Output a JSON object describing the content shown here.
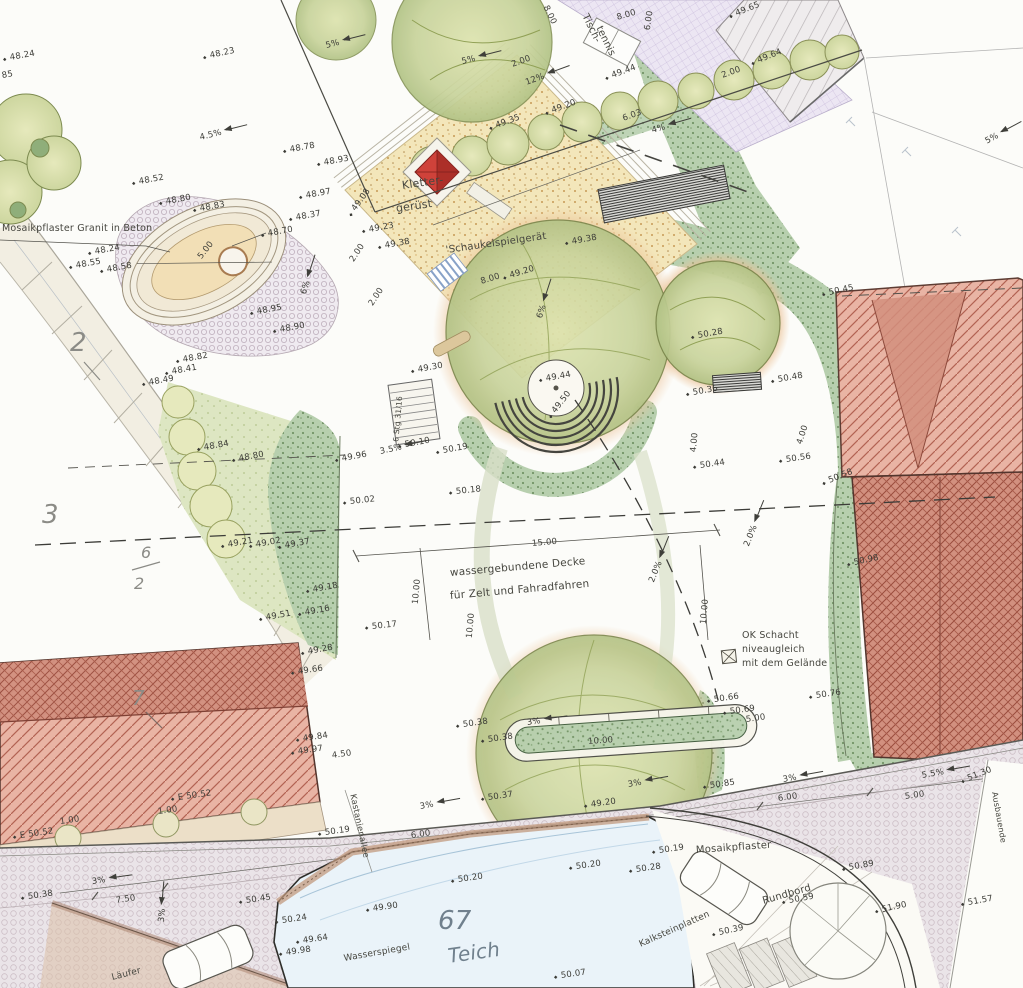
{
  "drawing": {
    "kind": "landscape-site-plan",
    "language": "de",
    "pond_parcel": "67",
    "parcels": [
      "2",
      "3",
      "6/2",
      "7",
      "67"
    ]
  },
  "colors": {
    "paper": "#fcfcf9",
    "roof_red_light": "#e9b4a4",
    "roof_red_dark": "#d2907f",
    "lawn_green": "#dde6c2",
    "shrub_green": "#b7cfae",
    "sand_yellow": "#f3e6ba",
    "pond_blue": "#eaf3f9",
    "pavement_grid": "#ece6f3",
    "road_mosaic": "#eae4e8",
    "play_structure_red": "#cf423a",
    "ink": "#3b3b36"
  },
  "texts": {
    "mosaic_note": "Mosaikpflaster Granit in Beton",
    "surface_note_line1": "wassergebundene Decke",
    "surface_note_line2": "für Zelt und Fahradfahren",
    "shaft_note": "OK Schacht niveaugleich mit dem Gelände",
    "pond_label": "Teich",
    "water_level": "Wasserspiegel",
    "street": "Kastanienallee"
  },
  "labels": [
    {
      "t": "48.23",
      "x": 210,
      "y": 52,
      "r": -12
    },
    {
      "t": "48.37",
      "x": 296,
      "y": 214,
      "r": -10
    },
    {
      "t": "48.24",
      "x": 10,
      "y": 54,
      "r": -10
    },
    {
      "t": "85",
      "x": 2,
      "y": 72,
      "r": -10
    },
    {
      "t": "4.5%",
      "x": 200,
      "y": 134,
      "r": -14,
      "k": "s"
    },
    {
      "t": "5%",
      "x": 326,
      "y": 42,
      "r": -14,
      "k": "s"
    },
    {
      "t": "5%",
      "x": 462,
      "y": 58,
      "r": -14,
      "k": "s"
    },
    {
      "t": "5%",
      "x": 986,
      "y": 138,
      "r": -28,
      "k": "s"
    },
    {
      "t": "48.78",
      "x": 290,
      "y": 146,
      "r": -10
    },
    {
      "t": "48.93",
      "x": 324,
      "y": 159,
      "r": -10
    },
    {
      "t": "48.97",
      "x": 306,
      "y": 192,
      "r": -10
    },
    {
      "t": "48.52",
      "x": 139,
      "y": 178,
      "r": -10
    },
    {
      "t": "48.80",
      "x": 166,
      "y": 198,
      "r": -10
    },
    {
      "t": "48.83",
      "x": 200,
      "y": 205,
      "r": -10
    },
    {
      "t": "48.70",
      "x": 268,
      "y": 230,
      "r": -10
    },
    {
      "t": "48.24",
      "x": 95,
      "y": 248,
      "r": -10
    },
    {
      "t": "48.55",
      "x": 76,
      "y": 262,
      "r": -10
    },
    {
      "t": "48.58",
      "x": 107,
      "y": 266,
      "r": -10
    },
    {
      "t": "5.00",
      "x": 200,
      "y": 254,
      "r": -52,
      "k": "d"
    },
    {
      "t": "48.95",
      "x": 257,
      "y": 308,
      "r": -10
    },
    {
      "t": "48.90",
      "x": 280,
      "y": 326,
      "r": -10
    },
    {
      "t": "6%",
      "x": 304,
      "y": 290,
      "r": -72,
      "k": "s"
    },
    {
      "t": "48.82",
      "x": 183,
      "y": 356,
      "r": -10
    },
    {
      "t": "48.41",
      "x": 172,
      "y": 368,
      "r": -10
    },
    {
      "t": "48.49",
      "x": 149,
      "y": 379,
      "r": -10
    },
    {
      "t": "Mosaikpflaster Granit in Beton",
      "x": 2,
      "y": 224,
      "r": 0,
      "s": 9.5,
      "k": "n"
    },
    {
      "t": "2",
      "x": 70,
      "y": 330,
      "r": 0,
      "s": 26,
      "k": "p"
    },
    {
      "t": "Kletter-",
      "x": 402,
      "y": 180,
      "r": -8,
      "s": 11,
      "k": "n"
    },
    {
      "t": "gerüst",
      "x": 396,
      "y": 203,
      "r": -8,
      "s": 11,
      "k": "n"
    },
    {
      "t": "'Schaukelspielgerät",
      "x": 446,
      "y": 246,
      "r": -8,
      "s": 10,
      "k": "n"
    },
    {
      "t": "49.08",
      "x": 354,
      "y": 206,
      "r": -54
    },
    {
      "t": "49.23",
      "x": 369,
      "y": 226,
      "r": -10
    },
    {
      "t": "49.38",
      "x": 385,
      "y": 242,
      "r": -10
    },
    {
      "t": "2.00",
      "x": 352,
      "y": 257,
      "r": -56,
      "k": "d"
    },
    {
      "t": "2.00",
      "x": 371,
      "y": 301,
      "r": -56,
      "k": "d"
    },
    {
      "t": "8.00",
      "x": 481,
      "y": 278,
      "r": -17,
      "k": "d"
    },
    {
      "t": "49.20",
      "x": 510,
      "y": 272,
      "r": -17
    },
    {
      "t": "49.38",
      "x": 572,
      "y": 238,
      "r": -10
    },
    {
      "t": "6%",
      "x": 540,
      "y": 314,
      "r": -72,
      "k": "s"
    },
    {
      "t": "49.30",
      "x": 418,
      "y": 366,
      "r": -10
    },
    {
      "t": "49.44",
      "x": 546,
      "y": 375,
      "r": -10
    },
    {
      "t": "49.50",
      "x": 554,
      "y": 408,
      "r": -52
    },
    {
      "t": "Tisch-",
      "x": 584,
      "y": 10,
      "r": 64,
      "s": 10,
      "k": "n"
    },
    {
      "t": "tennis",
      "x": 598,
      "y": 22,
      "r": 64,
      "s": 10,
      "k": "n"
    },
    {
      "t": "8.00",
      "x": 545,
      "y": 2,
      "r": 64,
      "k": "d"
    },
    {
      "t": "6.00",
      "x": 648,
      "y": 26,
      "r": -82,
      "k": "d"
    },
    {
      "t": "8.00",
      "x": 617,
      "y": 14,
      "r": -16,
      "k": "d"
    },
    {
      "t": "49.44",
      "x": 612,
      "y": 72,
      "r": -20
    },
    {
      "t": "49.65",
      "x": 736,
      "y": 10,
      "r": -22
    },
    {
      "t": "49.64",
      "x": 758,
      "y": 57,
      "r": -22
    },
    {
      "t": "2.00",
      "x": 512,
      "y": 61,
      "r": -20,
      "k": "d"
    },
    {
      "t": "2.00",
      "x": 722,
      "y": 72,
      "r": -20,
      "k": "d"
    },
    {
      "t": "12%",
      "x": 526,
      "y": 79,
      "r": -20,
      "k": "s"
    },
    {
      "t": "49.20",
      "x": 552,
      "y": 107,
      "r": -20
    },
    {
      "t": "49.35",
      "x": 496,
      "y": 122,
      "r": -20
    },
    {
      "t": "6.03",
      "x": 623,
      "y": 115,
      "r": -20,
      "k": "d"
    },
    {
      "t": "4%",
      "x": 652,
      "y": 127,
      "r": -16,
      "k": "s"
    },
    {
      "t": "6 Stg 31/16",
      "x": 396,
      "y": 438,
      "r": -85,
      "s": 7.5,
      "k": "n"
    },
    {
      "t": "50.10",
      "x": 405,
      "y": 441,
      "r": -10
    },
    {
      "t": "50.19",
      "x": 443,
      "y": 447,
      "r": -10
    },
    {
      "t": "49.96",
      "x": 342,
      "y": 455,
      "r": -10
    },
    {
      "t": "3.5%",
      "x": 380,
      "y": 448,
      "r": -12,
      "k": "s"
    },
    {
      "t": "50.02",
      "x": 350,
      "y": 498,
      "r": -6
    },
    {
      "t": "50.18",
      "x": 456,
      "y": 488,
      "r": -6
    },
    {
      "t": "15.00",
      "x": 532,
      "y": 540,
      "r": -5,
      "k": "d"
    },
    {
      "t": "10.00",
      "x": 416,
      "y": 600,
      "r": -85,
      "k": "d"
    },
    {
      "t": "10.00",
      "x": 470,
      "y": 634,
      "r": -85,
      "k": "d"
    },
    {
      "t": "10.00",
      "x": 704,
      "y": 620,
      "r": -85,
      "k": "d"
    },
    {
      "t": "wassergebundene Decke",
      "x": 450,
      "y": 568,
      "r": -5,
      "s": 10.5,
      "k": "n"
    },
    {
      "t": "für Zelt und Fahradfahren",
      "x": 450,
      "y": 591,
      "r": -5,
      "s": 10.5,
      "k": "n"
    },
    {
      "t": "50.17",
      "x": 372,
      "y": 623,
      "r": -6
    },
    {
      "t": "2.0%",
      "x": 652,
      "y": 578,
      "r": -68,
      "k": "s"
    },
    {
      "t": "2.0%",
      "x": 747,
      "y": 542,
      "r": -68,
      "k": "s"
    },
    {
      "t": "3",
      "x": 42,
      "y": 502,
      "r": 0,
      "s": 26,
      "k": "p"
    },
    {
      "t": "6",
      "x": 141,
      "y": 545,
      "r": 0,
      "s": 16,
      "k": "p"
    },
    {
      "t": "2",
      "x": 134,
      "y": 576,
      "r": 0,
      "s": 16,
      "k": "p"
    },
    {
      "t": "48.84",
      "x": 204,
      "y": 444,
      "r": -10
    },
    {
      "t": "48.80",
      "x": 239,
      "y": 455,
      "r": -10
    },
    {
      "t": "49.21",
      "x": 228,
      "y": 541,
      "r": -10
    },
    {
      "t": "49.02",
      "x": 256,
      "y": 541,
      "r": -10
    },
    {
      "t": "49.37",
      "x": 285,
      "y": 542,
      "r": -10
    },
    {
      "t": "49.18",
      "x": 313,
      "y": 586,
      "r": -10
    },
    {
      "t": "49.16",
      "x": 305,
      "y": 609,
      "r": -10
    },
    {
      "t": "49.51",
      "x": 266,
      "y": 614,
      "r": -10
    },
    {
      "t": "49.28",
      "x": 308,
      "y": 648,
      "r": -10
    },
    {
      "t": "50.45",
      "x": 829,
      "y": 289,
      "r": -12
    },
    {
      "t": "50.28",
      "x": 698,
      "y": 332,
      "r": -10
    },
    {
      "t": "50.48",
      "x": 778,
      "y": 376,
      "r": -10
    },
    {
      "t": "50.36",
      "x": 693,
      "y": 389,
      "r": -10
    },
    {
      "t": "4.00",
      "x": 694,
      "y": 448,
      "r": -85,
      "k": "d"
    },
    {
      "t": "4.00",
      "x": 800,
      "y": 440,
      "r": -72,
      "k": "d"
    },
    {
      "t": "50.44",
      "x": 700,
      "y": 462,
      "r": -8
    },
    {
      "t": "50.56",
      "x": 786,
      "y": 456,
      "r": -8
    },
    {
      "t": "50.58",
      "x": 829,
      "y": 477,
      "r": -22
    },
    {
      "t": "50.98",
      "x": 854,
      "y": 559,
      "r": -12
    },
    {
      "t": "OK Schacht",
      "x": 742,
      "y": 631,
      "r": 0,
      "s": 9.5,
      "k": "n"
    },
    {
      "t": "niveaugleich",
      "x": 742,
      "y": 645,
      "r": 0,
      "s": 9.5,
      "k": "n"
    },
    {
      "t": "mit dem Gelände",
      "x": 742,
      "y": 659,
      "r": 0,
      "s": 9.5,
      "k": "n"
    },
    {
      "t": "50.76",
      "x": 816,
      "y": 692,
      "r": -8
    },
    {
      "t": "50.66",
      "x": 714,
      "y": 696,
      "r": -8
    },
    {
      "t": "50.69",
      "x": 730,
      "y": 708,
      "r": -8
    },
    {
      "t": "5.00",
      "x": 746,
      "y": 716,
      "r": -8,
      "k": "d"
    },
    {
      "t": "10.00",
      "x": 588,
      "y": 738,
      "r": -4,
      "k": "d"
    },
    {
      "t": "50.38",
      "x": 463,
      "y": 721,
      "r": -8
    },
    {
      "t": "50.38",
      "x": 488,
      "y": 736,
      "r": -8
    },
    {
      "t": "3%",
      "x": 527,
      "y": 719,
      "r": -8,
      "k": "s"
    },
    {
      "t": "3%",
      "x": 628,
      "y": 781,
      "r": -10,
      "k": "s"
    },
    {
      "t": "49.20",
      "x": 591,
      "y": 801,
      "r": -8
    },
    {
      "t": "50.37",
      "x": 488,
      "y": 794,
      "r": -8
    },
    {
      "t": "4.50",
      "x": 332,
      "y": 752,
      "r": -8,
      "k": "d"
    },
    {
      "t": "50.85",
      "x": 710,
      "y": 782,
      "r": -8
    },
    {
      "t": "5.5%",
      "x": 922,
      "y": 772,
      "r": -10,
      "k": "s"
    },
    {
      "t": "51.30",
      "x": 968,
      "y": 775,
      "r": -22
    },
    {
      "t": "3%",
      "x": 783,
      "y": 776,
      "r": -10,
      "k": "s"
    },
    {
      "t": "6.00",
      "x": 778,
      "y": 795,
      "r": -8,
      "k": "d"
    },
    {
      "t": "5.00",
      "x": 905,
      "y": 793,
      "r": -8,
      "k": "d"
    },
    {
      "t": "Ausbauende",
      "x": 994,
      "y": 788,
      "r": 80,
      "s": 8,
      "k": "n"
    },
    {
      "t": "50.19",
      "x": 659,
      "y": 847,
      "r": -8
    },
    {
      "t": "Mosaikpflaster",
      "x": 696,
      "y": 846,
      "r": -4,
      "s": 10,
      "k": "n"
    },
    {
      "t": "50.89",
      "x": 849,
      "y": 864,
      "r": -10
    },
    {
      "t": "Rundbord",
      "x": 763,
      "y": 897,
      "r": -16,
      "s": 10,
      "k": "n"
    },
    {
      "t": "50.59",
      "x": 789,
      "y": 897,
      "r": -10
    },
    {
      "t": "51.90",
      "x": 882,
      "y": 906,
      "r": -12
    },
    {
      "t": "51.57",
      "x": 968,
      "y": 899,
      "r": -10
    },
    {
      "t": "50.39",
      "x": 719,
      "y": 929,
      "r": -12
    },
    {
      "t": "Kalksteinplatten",
      "x": 640,
      "y": 941,
      "r": -24,
      "s": 9,
      "k": "n"
    },
    {
      "t": "50.07",
      "x": 561,
      "y": 972,
      "r": -8
    },
    {
      "t": "67",
      "x": 438,
      "y": 908,
      "r": 0,
      "s": 26,
      "k": "w"
    },
    {
      "t": "Teich",
      "x": 448,
      "y": 946,
      "r": -8,
      "s": 20,
      "k": "w"
    },
    {
      "t": "Wasserspiegel",
      "x": 344,
      "y": 955,
      "r": -10,
      "s": 9,
      "k": "n"
    },
    {
      "t": "49.90",
      "x": 373,
      "y": 905,
      "r": -8
    },
    {
      "t": "50.20",
      "x": 458,
      "y": 876,
      "r": -8
    },
    {
      "t": "50.20",
      "x": 576,
      "y": 863,
      "r": -8
    },
    {
      "t": "50.28",
      "x": 636,
      "y": 866,
      "r": -8
    },
    {
      "t": "50.24",
      "x": 282,
      "y": 917,
      "r": -8
    },
    {
      "t": "49.64",
      "x": 303,
      "y": 937,
      "r": -8
    },
    {
      "t": "49.98",
      "x": 286,
      "y": 949,
      "r": -8
    },
    {
      "t": "6.00",
      "x": 411,
      "y": 832,
      "r": -8,
      "k": "d"
    },
    {
      "t": "3%",
      "x": 420,
      "y": 803,
      "r": -10,
      "k": "s"
    },
    {
      "t": "50.19",
      "x": 325,
      "y": 829,
      "r": -8
    },
    {
      "t": "Kastanienallee",
      "x": 352,
      "y": 790,
      "r": 78,
      "s": 8.5,
      "k": "n"
    },
    {
      "t": "7.50",
      "x": 116,
      "y": 897,
      "r": -8,
      "k": "d"
    },
    {
      "t": "50.45",
      "x": 246,
      "y": 897,
      "r": -8
    },
    {
      "t": "3%",
      "x": 92,
      "y": 878,
      "r": -8,
      "k": "s"
    },
    {
      "t": "3%",
      "x": 162,
      "y": 918,
      "r": -85,
      "k": "s"
    },
    {
      "t": "50.38",
      "x": 28,
      "y": 893,
      "r": -8
    },
    {
      "t": "E 50.52",
      "x": 178,
      "y": 794,
      "r": -8
    },
    {
      "t": "1.00",
      "x": 158,
      "y": 808,
      "r": -8,
      "k": "d"
    },
    {
      "t": "1.00",
      "x": 60,
      "y": 818,
      "r": -8,
      "k": "d"
    },
    {
      "t": "E 50.52",
      "x": 20,
      "y": 832,
      "r": -8
    },
    {
      "t": "7",
      "x": 132,
      "y": 688,
      "r": 0,
      "s": 20,
      "k": "p"
    },
    {
      "t": "Läufer",
      "x": 112,
      "y": 974,
      "r": -14,
      "s": 9,
      "k": "n"
    },
    {
      "t": "49.66",
      "x": 298,
      "y": 668,
      "r": -8
    },
    {
      "t": "49.84",
      "x": 303,
      "y": 735,
      "r": -8
    },
    {
      "t": "49.97",
      "x": 298,
      "y": 748,
      "r": -8
    }
  ]
}
